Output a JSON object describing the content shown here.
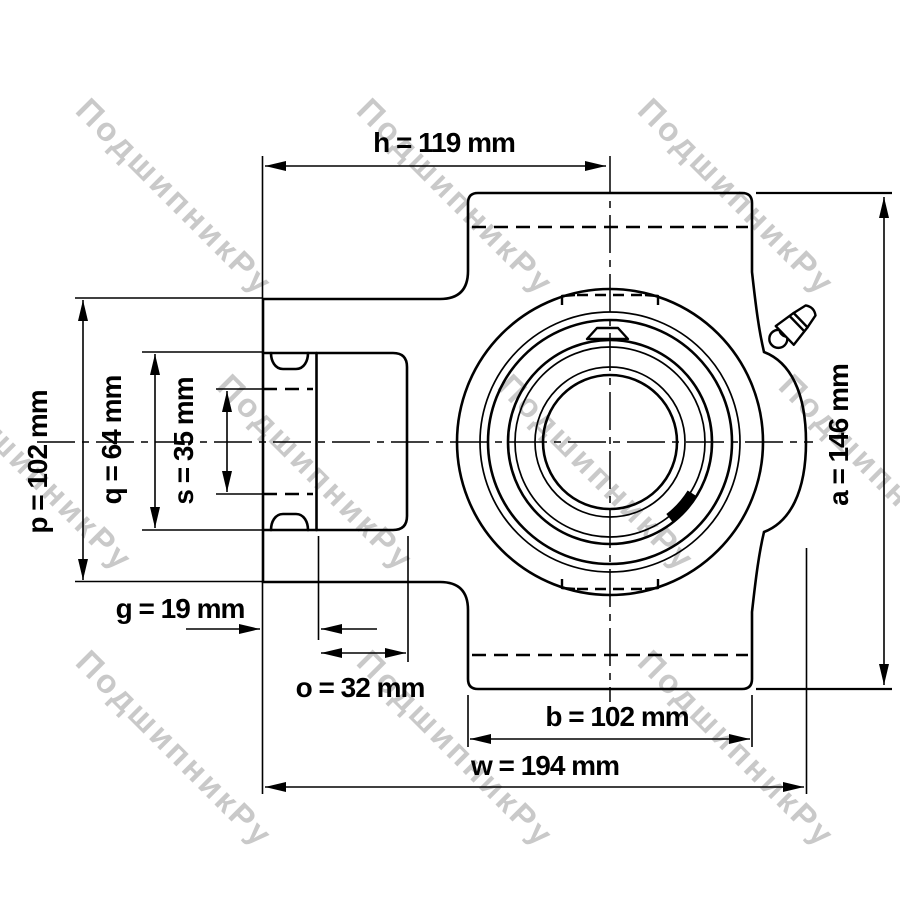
{
  "watermark": {
    "text": "ПодшипникРу"
  },
  "dims": {
    "h": {
      "label": "h = 119 mm",
      "value_mm": 119
    },
    "p": {
      "label": "p = 102 mm",
      "value_mm": 102
    },
    "q": {
      "label": "q = 64 mm",
      "value_mm": 64
    },
    "s": {
      "label": "s = 35 mm",
      "value_mm": 35
    },
    "g": {
      "label": "g = 19 mm",
      "value_mm": 19
    },
    "o": {
      "label": "o = 32 mm",
      "value_mm": 32
    },
    "b": {
      "label": "b = 102 mm",
      "value_mm": 102
    },
    "w": {
      "label": "w = 194 mm",
      "value_mm": 194
    },
    "a": {
      "label": "a = 146 mm",
      "value_mm": 146
    }
  },
  "colors": {
    "line": "#000000",
    "bore_fill": "#d6d6d6",
    "watermark": "#c9c9c9",
    "background": "#ffffff"
  }
}
